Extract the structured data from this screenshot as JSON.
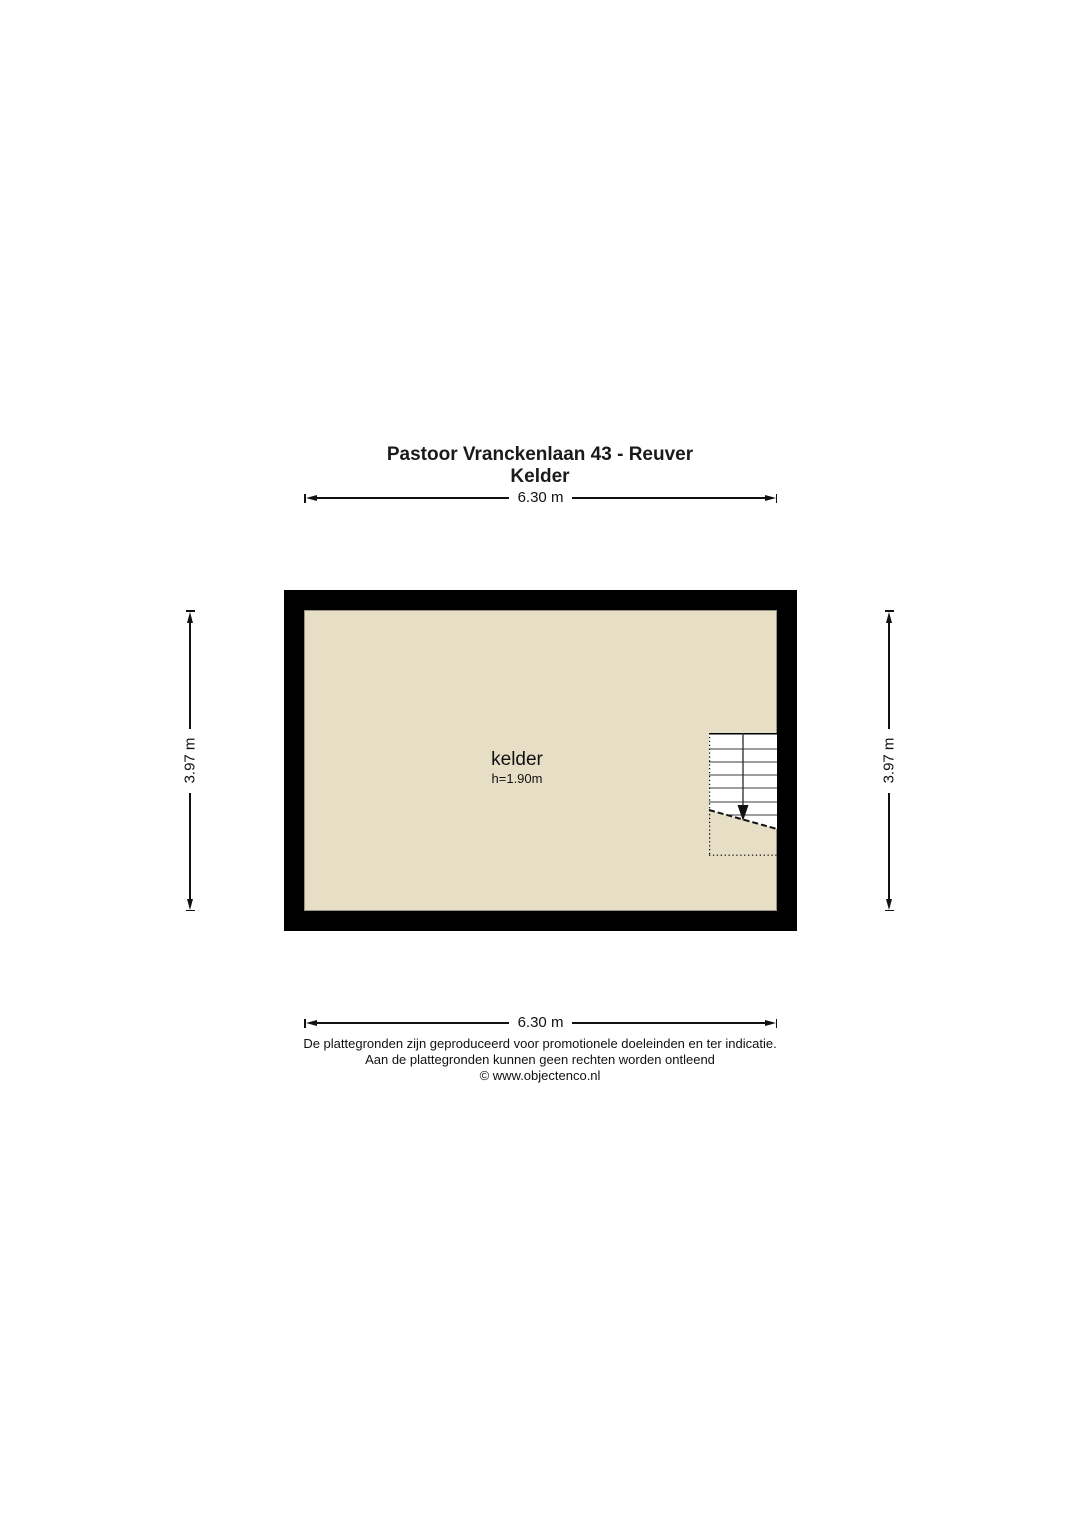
{
  "title": {
    "address": "Pastoor Vranckenlaan 43 - Reuver",
    "floor": "Kelder"
  },
  "dimensions": {
    "top": "6.30 m",
    "bottom": "6.30 m",
    "left": "3.97 m",
    "right": "3.97 m"
  },
  "room": {
    "label": "kelder",
    "ceiling_height": "h=1.90m"
  },
  "stairs": {
    "direction": "down"
  },
  "colors": {
    "wall": "#000000",
    "floor": "#e6dfc6",
    "stairs_fill": "#ffffff",
    "line": "#111111"
  },
  "footer": {
    "line1": "De plattegronden zijn geproduceerd voor promotionele doeleinden en ter indicatie.",
    "line2": "Aan de plattegronden kunnen geen rechten worden ontleend",
    "line3": "© www.objectenco.nl"
  }
}
